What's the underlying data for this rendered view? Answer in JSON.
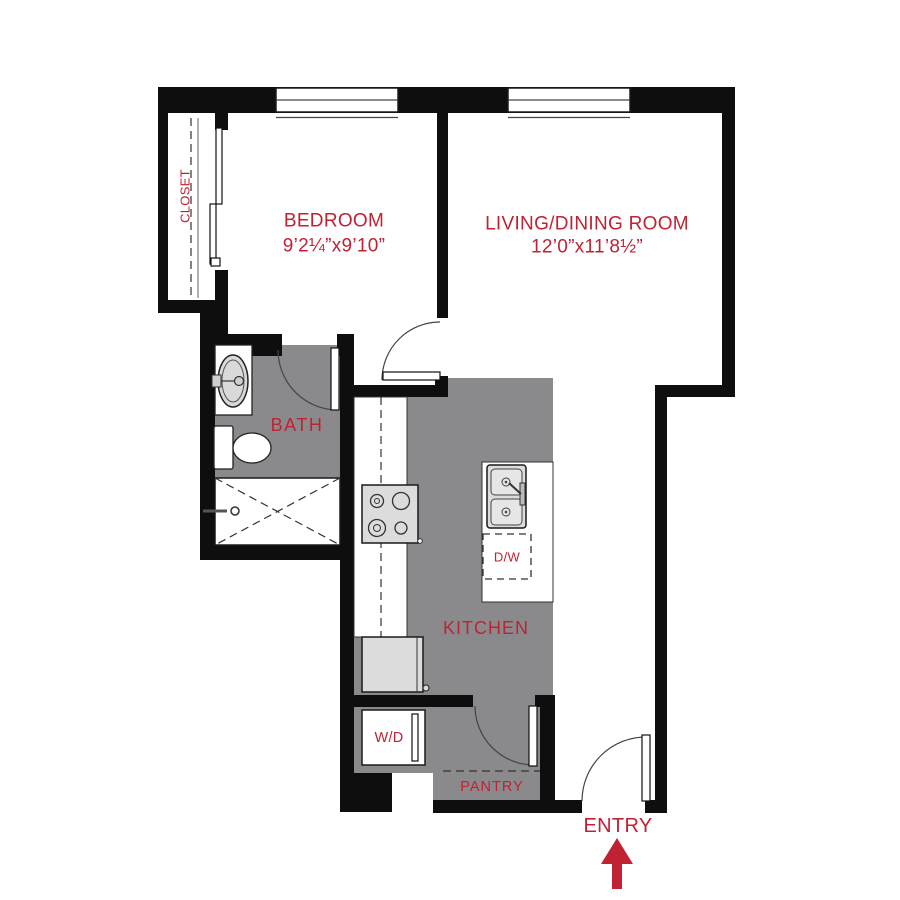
{
  "colors": {
    "label_red": "#C02233",
    "floor_gray": "#8A8A8C",
    "wall_black": "#0E0E0E",
    "appliance_fill": "#DCDCDC",
    "appliance_inner": "#E6E6E6",
    "line_dark": "#333333"
  },
  "rooms": {
    "closet": {
      "label": "CLOSET"
    },
    "bedroom": {
      "label": "BEDROOM",
      "dimensions": "9’2¼”x9’10”"
    },
    "living_dining": {
      "label": "LIVING/DINING ROOM",
      "dimensions": "12’0”x11’8½”"
    },
    "bath": {
      "label": "BATH"
    },
    "kitchen": {
      "label": "KITCHEN"
    },
    "pantry": {
      "label": "PANTRY"
    }
  },
  "appliances": {
    "dishwasher": {
      "label": "D/W"
    },
    "washer_dryer": {
      "label": "W/D"
    }
  },
  "entry": {
    "label": "ENTRY"
  }
}
